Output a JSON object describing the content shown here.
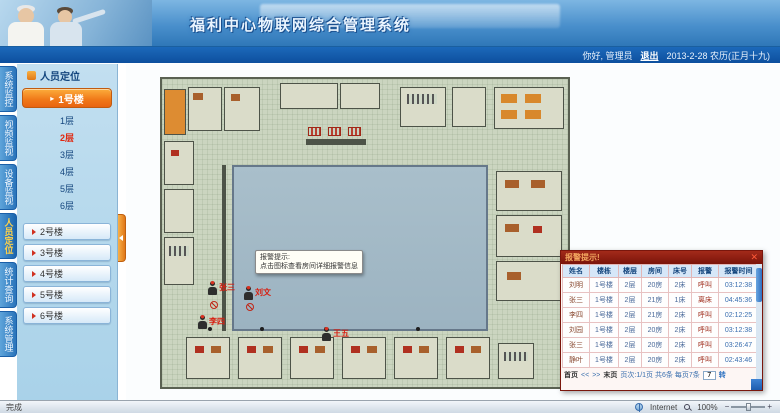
{
  "header": {
    "title": "福利中心物联网综合管理系统",
    "greeting": "你好, 管理员",
    "logout": "退出",
    "date": "2013-2-28 农历(正月十九)"
  },
  "nav_tabs": [
    {
      "label": "系统监控"
    },
    {
      "label": "视频监视"
    },
    {
      "label": "设备监视"
    },
    {
      "label": "人员定位"
    },
    {
      "label": "统计查询"
    },
    {
      "label": "系统管理"
    }
  ],
  "sidebar": {
    "panel_title": "人员定位",
    "active_building": "1号楼",
    "floors": [
      "1层",
      "2层",
      "3层",
      "4层",
      "5层",
      "6层"
    ],
    "active_floor": "2层",
    "buildings": [
      "2号楼",
      "3号楼",
      "4号楼",
      "5号楼",
      "6号楼"
    ]
  },
  "floorplan": {
    "tooltip": {
      "line1": "报警提示:",
      "line2": "点击图标查看房间详细报警信息"
    },
    "markers": [
      {
        "name": "张三"
      },
      {
        "name": "刘文"
      },
      {
        "name": "李四"
      },
      {
        "name": "王五"
      }
    ]
  },
  "alarm_panel": {
    "title": "报警提示!",
    "close": "✕",
    "columns": [
      "姓名",
      "楼栋",
      "楼层",
      "房间",
      "床号",
      "报警",
      "报警时间"
    ],
    "rows": [
      [
        "刘明",
        "1号楼",
        "2层",
        "20房",
        "2床",
        "呼叫",
        "03:12:38"
      ],
      [
        "张三",
        "1号楼",
        "2层",
        "21房",
        "1床",
        "离床",
        "04:45:36"
      ],
      [
        "李四",
        "1号楼",
        "2层",
        "21房",
        "2床",
        "呼叫",
        "02:12:25"
      ],
      [
        "刘园",
        "1号楼",
        "2层",
        "20房",
        "2床",
        "呼叫",
        "03:12:38"
      ],
      [
        "张三",
        "1号楼",
        "2层",
        "20房",
        "2床",
        "呼叫",
        "03:26:47"
      ],
      [
        "静叶",
        "1号楼",
        "2层",
        "20房",
        "2床",
        "呼叫",
        "02:43:46"
      ]
    ],
    "pagination": {
      "first": "首页",
      "prev": "<<",
      "next": ">>",
      "last": "末页",
      "info": "页次:1/1页 共6条 每页7条",
      "page_input": "7",
      "go": "转"
    }
  },
  "statusbar": {
    "left": "完成",
    "zone": "Internet",
    "zoom": "100%"
  },
  "colors": {
    "accent_orange": "#f07818",
    "nav_blue": "#2a74ba",
    "alarm_red": "#7a140a",
    "active_floor_red": "#e02810"
  }
}
